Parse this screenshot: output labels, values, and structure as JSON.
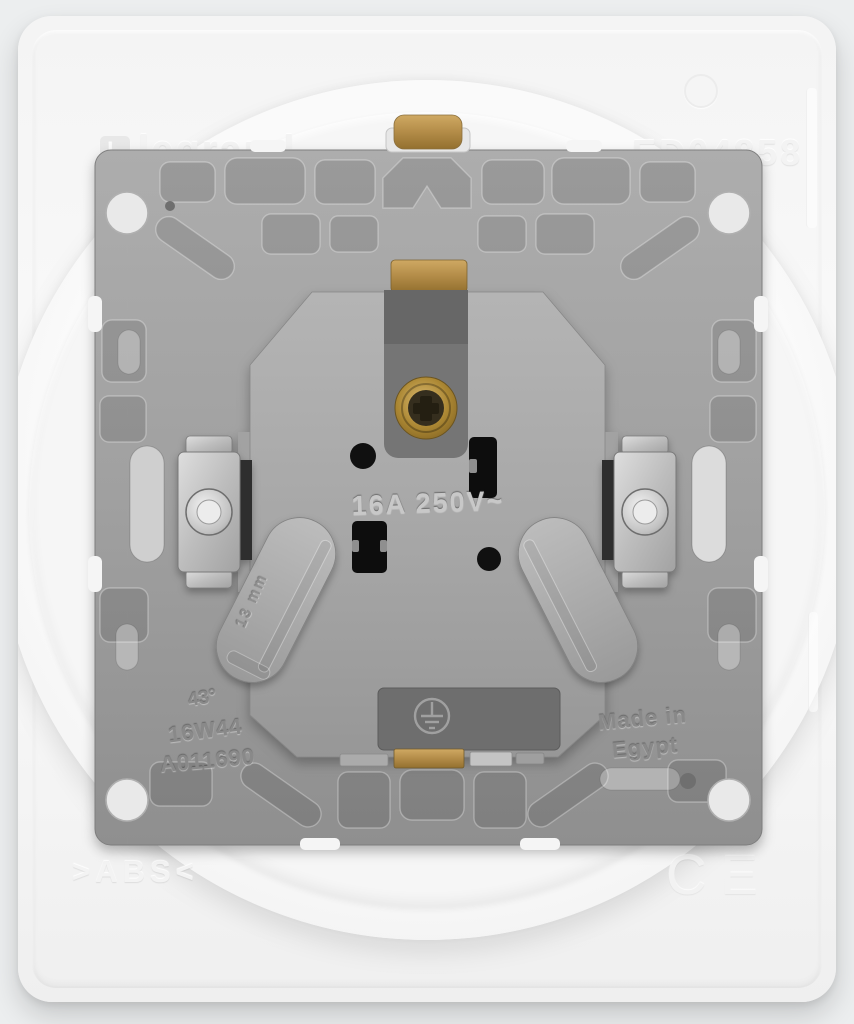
{
  "product": {
    "brand": "legrand",
    "logo_letter": "L",
    "part_number": "ED04858",
    "rating": "16A 250V~",
    "claw_depth": "13 mm",
    "spec_angle": "43°",
    "code_line1": "16W44",
    "code_line2": "A011690",
    "origin_line1": "Made in",
    "origin_line2": "Egypt",
    "material": ">ABS<",
    "certification": "CE"
  },
  "colors": {
    "faceplate_white": "#f6f6f6",
    "frame_gray": "#9c9c9c",
    "mechanism_gray": "#a5a5a5",
    "recess_dark": "#747474",
    "brass": "#b08c4a",
    "slot_black": "#101010",
    "metal_silver": "#c9c9c9"
  }
}
